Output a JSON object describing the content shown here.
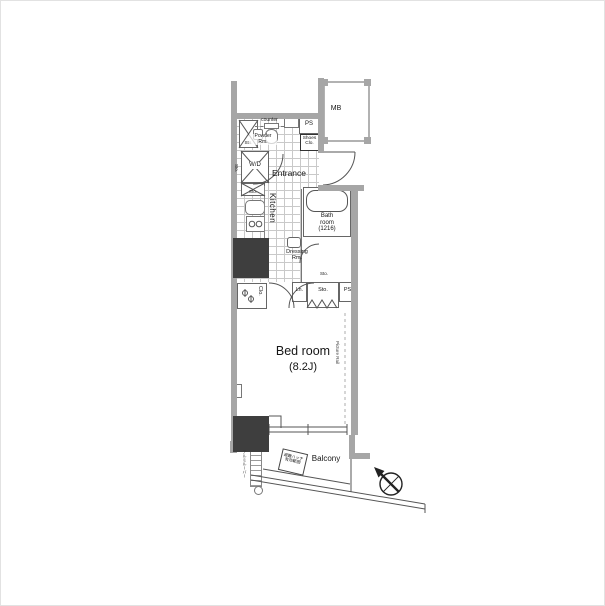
{
  "plan": {
    "type": "apartment-floor-plan",
    "labels": {
      "mb": "MB",
      "ps_top": "PS",
      "counter": "counter",
      "shoes_l1": "Shoes",
      "shoes_l2": "Clo.",
      "sto_entry": "Sto.",
      "powder_l1": "Powder",
      "powder_l2": "Rm.",
      "wd": "W/D",
      "sto_wd": "Sto.",
      "sto_kitchen": "Sto.",
      "entrance": "Entrance",
      "kitchen": "Kitchen",
      "bath_l1": "Bath",
      "bath_l2": "room",
      "bath_l3": "(1216)",
      "dressing_l1": "Dressing",
      "dressing_l2": "Rm.",
      "sto_dressing": "Sto.",
      "clo": "Clo.",
      "ln": "Ln.",
      "sto_main": "Sto.",
      "ps_bottom": "PS",
      "bedroom": "Bed room",
      "bedroom_size": "(8.2J)",
      "picture_rail": "Picture Rail",
      "balcony": "Balcony",
      "louver": "アルミルーバー",
      "hatch_l1": "避難ハッチ",
      "hatch_l2": "有効範囲"
    },
    "colors": {
      "wall": "#a6a6a6",
      "pillar": "#3e3e3e",
      "line": "#555555",
      "tile_grid": "#c9c9c9"
    }
  }
}
